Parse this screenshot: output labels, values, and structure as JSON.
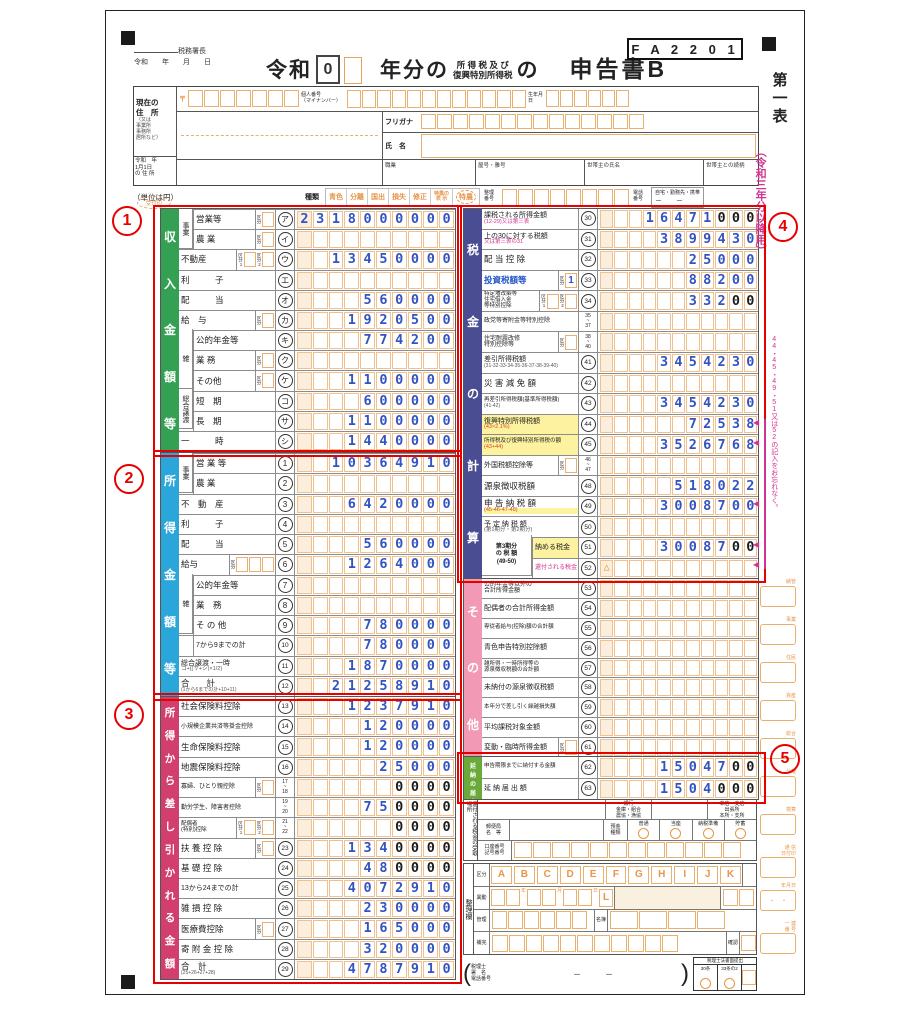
{
  "header": {
    "tax_office": "税務署長",
    "date_line": "令和　　年　　月　　日",
    "era_label": "令和",
    "era_value": "0",
    "title_year": "年分の",
    "title_tax_top": "所 得 税 及 び",
    "title_tax_bottom": "復興特別所得税",
    "title_no": "の",
    "title_form": "申告書B",
    "form_code": "F A 2 2 0 1",
    "current_address": [
      "現在の",
      "住　所"
    ],
    "address_alt": [
      "（又は",
      "事業所",
      "事務所",
      "居所など）"
    ],
    "postal_mark": "〒",
    "my_number_label": [
      "個人番号",
      "（マイナンバー）"
    ],
    "birth_label": "生年月日",
    "furigana_label": "フリガナ",
    "name_label": "氏　名",
    "jan1_label": [
      "令和　年",
      "1月1日",
      "の 住 所"
    ],
    "occupation_label": "職業",
    "trade_label": "屋号・雅号",
    "householder_label": "世帯主の氏名",
    "relation_label": "世帯主との続柄",
    "stamp_label": "受付印",
    "unit_note": "（単位は円）",
    "type_label": "種類",
    "types": [
      "青色",
      "分離",
      "国出",
      "損失",
      "修正",
      "特農の\n表 示",
      "特農"
    ],
    "serial_label": "整理\n番号",
    "phone_label": "電話\n番号",
    "phone_note": "自宅・勤務先・携帯",
    "phone_dashes": "－　　－"
  },
  "margin": {
    "sheet_name": "第一表",
    "edition": "（令和三年分以降用）",
    "reminder": "44・45・49・51又は52の記入をお忘れなく。",
    "boxes": [
      "納管",
      "事業",
      "住民",
      "資産",
      "総合",
      "分離",
      "検算",
      "通 信\n日付印",
      "年月日",
      "一 連\n番 号"
    ]
  },
  "annotations": [
    "1",
    "2",
    "3",
    "4",
    "5"
  ],
  "sections": {
    "income": {
      "bar": "収入金額等",
      "color": "#33a053",
      "slots": 10,
      "rows": [
        {
          "g": "事業",
          "gs": 2,
          "l": "営業等",
          "k": [
            {
              "t": "区分"
            }
          ],
          "c": "ア",
          "v": "2318000000"
        },
        {
          "g": "",
          "l": "農 業",
          "k": [
            {
              "t": "区分"
            }
          ],
          "c": "イ",
          "v": ""
        },
        {
          "l": "不動産",
          "k": [
            {
              "t": "区分1"
            },
            {
              "t": "区分2"
            }
          ],
          "c": "ウ",
          "v": "13450000"
        },
        {
          "l": "利　　　子",
          "c": "エ",
          "v": ""
        },
        {
          "l": "配　　　当",
          "c": "オ",
          "v": "560000"
        },
        {
          "l": "給　与",
          "k": [
            {
              "t": "区分"
            }
          ],
          "c": "カ",
          "v": "1920500"
        },
        {
          "g": "雑",
          "gs": 3,
          "l": "公的年金等",
          "c": "キ",
          "v": "774200"
        },
        {
          "g": "",
          "l": "業 務",
          "k": [
            {
              "t": "区分"
            }
          ],
          "c": "ク",
          "v": ""
        },
        {
          "g": "",
          "l": "その他",
          "k": [
            {
              "t": "区分"
            }
          ],
          "c": "ケ",
          "v": "1100000"
        },
        {
          "g": "総合譲渡",
          "gs": 2,
          "l": "短　期",
          "c": "コ",
          "v": "600000"
        },
        {
          "g": "",
          "l": "長　期",
          "c": "サ",
          "v": "1100000"
        },
        {
          "l": "一　　　時",
          "c": "シ",
          "v": "1440000"
        }
      ]
    },
    "shotoku": {
      "bar": "所得金額等",
      "color": "#2ba6da",
      "slots": 10,
      "rows": [
        {
          "g": "事業",
          "gs": 2,
          "l": "営 業 等",
          "c": "1",
          "v": "10364910"
        },
        {
          "g": "",
          "l": "農 業",
          "c": "2",
          "v": ""
        },
        {
          "l": "不　動　産",
          "c": "3",
          "v": "6420000"
        },
        {
          "l": "利　　　子",
          "c": "4",
          "v": ""
        },
        {
          "l": "配　　　当",
          "c": "5",
          "v": "560000"
        },
        {
          "l": "給与",
          "k": [
            {
              "t": "区分",
              "n": 3
            }
          ],
          "c": "6",
          "v": "1264000"
        },
        {
          "g": "雑",
          "gs": 3,
          "l": "公的年金等",
          "c": "7",
          "v": ""
        },
        {
          "g": "",
          "l": "業　務",
          "c": "8",
          "v": ""
        },
        {
          "g": "",
          "l": "そ の 他",
          "c": "9",
          "v": "780000"
        },
        {
          "g": "",
          "l": "7から9までの計",
          "lcls": "sm",
          "c": "10",
          "v": "780000"
        },
        {
          "l": "総合譲渡・一時",
          "lcls": "sm",
          "sub": "コ+{(サ+シ)×1/2}",
          "c": "11",
          "v": "1870000"
        },
        {
          "l": "合　　計",
          "sub": "(1から6までの計+10+11)",
          "scls": "xxs",
          "c": "12",
          "v": "21258910"
        }
      ]
    },
    "deductions": {
      "bar": "所得から差し引かれる金額",
      "color": "#d23f6e",
      "slots": 10,
      "rows": [
        {
          "l": "社会保険料控除",
          "c": "13",
          "v": "1237910"
        },
        {
          "l": "小規模企業共済等掛金控除",
          "lcls": "xs",
          "c": "14",
          "v": "120000"
        },
        {
          "l": "生命保険料控除",
          "c": "15",
          "v": "120000"
        },
        {
          "l": "地震保険料控除",
          "c": "16",
          "v": "25000"
        },
        {
          "l": "寡婦、ひとり親控除",
          "lcls": "xs",
          "k": [
            {
              "t": "区分"
            }
          ],
          "c": "17~18",
          "v": "0000",
          "b": 4
        },
        {
          "l": "勤労学生、障害者控除",
          "lcls": "xs",
          "c": "19~20",
          "v": "750000",
          "b": 4
        },
        {
          "l": "配偶者\n(特別)控除",
          "lcls": "xxs",
          "k": [
            {
              "t": "区分1"
            },
            {
              "t": "区分2"
            }
          ],
          "c": "21~22",
          "v": "0000",
          "b": 4
        },
        {
          "l": "扶 養 控 除",
          "k": [
            {
              "t": "区分"
            }
          ],
          "c": "23",
          "v": "1340000",
          "b": 4
        },
        {
          "l": "基 礎 控 除",
          "c": "24",
          "v": "480000",
          "b": 4
        },
        {
          "l": "13から24までの計",
          "lcls": "sm",
          "c": "25",
          "v": "4072910"
        },
        {
          "l": "雑 損 控 除",
          "c": "26",
          "v": "230000"
        },
        {
          "l": "医療費控除",
          "k": [
            {
              "t": "区分"
            }
          ],
          "c": "27",
          "v": "165000"
        },
        {
          "l": "寄 附 金 控 除",
          "c": "28",
          "v": "320000"
        },
        {
          "l": "合　計",
          "sub": "(25+26+27+28)",
          "scls": "xxs",
          "c": "29",
          "v": "4787910"
        }
      ]
    },
    "tax": {
      "bar": "税金の計算",
      "color": "#4b4d92",
      "slots": 11,
      "rows": [
        {
          "l": "課税される所得金額",
          "lcls": "sm",
          "sub": "(12-29)又は第三表",
          "scls": "mag",
          "c": "30",
          "v": "16471000",
          "b": 3
        },
        {
          "l": "上の30に対する税額",
          "lcls": "sm",
          "sub": "又は第三表の31",
          "scls": "mag",
          "c": "31",
          "v": "3899430"
        },
        {
          "l": "配 当 控 除",
          "c": "32",
          "v": "25000"
        },
        {
          "l": "投資税額等",
          "lcls": "blue",
          "k": [
            {
              "t": "区分",
              "v": "1"
            }
          ],
          "c": "33",
          "v": "88200"
        },
        {
          "l": "特定増改築等\n住宅借入金\n等特別控除",
          "lcls": "xxs",
          "k": [
            {
              "t": "区分1"
            },
            {
              "t": "区分2"
            }
          ],
          "c": "34",
          "v": "33200",
          "b": 2
        },
        {
          "l": "政党等寄附金等特別控除",
          "lcls": "xs",
          "c": "35~37",
          "v": ""
        },
        {
          "l": "住宅耐震改修\n特別控除等",
          "lcls": "xs",
          "k": [
            {
              "t": "区分"
            }
          ],
          "c": "38~40",
          "v": ""
        },
        {
          "l": "差引所得税額",
          "lcls": "sm",
          "sub": "(31-32-33-34-35-36-37-38-39-40)",
          "scls": "xxs",
          "c": "41",
          "v": "3454230"
        },
        {
          "l": "災 害 減 免 額",
          "c": "42",
          "v": ""
        },
        {
          "l": "再差引所得税額(基準所得税額)",
          "lcls": "xxs",
          "sub": "(41-42)",
          "scls": "xxs",
          "c": "43",
          "v": "3454230"
        },
        {
          "l": "復興特別所得税額",
          "lcls": "sm",
          "lbg": "#fdf2a0",
          "sub": "(43×2.1%)",
          "scls": "red",
          "c": "44",
          "v": "72538"
        },
        {
          "l": "所得税及び復興特別所得税の額",
          "lcls": "xxs",
          "lbg": "#fdf2a0",
          "sub": "(43+44)",
          "scls": "red",
          "c": "45",
          "v": "3526768"
        },
        {
          "l": "外国税額控除等",
          "lcls": "sm",
          "k": [
            {
              "t": "区分"
            }
          ],
          "c": "46~47",
          "v": ""
        },
        {
          "l": "源泉徴収税額",
          "c": "48",
          "v": "518022"
        },
        {
          "l": "申 告 納 税 額",
          "sub": "(45-46-47-48)",
          "scls": "red",
          "sbg": "#fdf2a0",
          "c": "49",
          "v": "3008700"
        },
        {
          "l": "予 定 納 税 額",
          "lcls": "sm",
          "sub": "(第1期分・第2期分)",
          "c": "50",
          "v": ""
        },
        {
          "g": "第3期分\nの 税 額\n(49-50)",
          "gs": 2,
          "gw": 50,
          "gcls": "wide",
          "l": "納める税金",
          "lcls": "sm",
          "lbg": "#fdf2a0",
          "c": "51",
          "v": "3008700",
          "b": 2
        },
        {
          "g": "",
          "gw": 50,
          "l": "還付される税金",
          "lcls": "xs mag",
          "c": "52",
          "v": "",
          "tri": true
        }
      ]
    },
    "other": {
      "bar": "その他",
      "color": "#f29ab5",
      "slots": 11,
      "rows": [
        {
          "l": "公的年金等以外の\n合計所得金額",
          "lcls": "xs",
          "c": "53",
          "v": ""
        },
        {
          "l": "配偶者の合計所得金額",
          "lcls": "sm",
          "c": "54",
          "v": ""
        },
        {
          "l": "専従者給与(控除)額の合計額",
          "lcls": "xxs",
          "c": "55",
          "v": ""
        },
        {
          "l": "青色申告特別控除額",
          "lcls": "sm",
          "c": "56",
          "v": ""
        },
        {
          "l": "雑所得・一時所得等の\n源泉徴収税額の合計額",
          "lcls": "xxs",
          "c": "57",
          "v": ""
        },
        {
          "l": "未納付の源泉徴収税額",
          "lcls": "sm",
          "c": "58",
          "v": ""
        },
        {
          "l": "本年分で差し引く繰越損失額",
          "lcls": "xxs",
          "c": "59",
          "v": ""
        },
        {
          "l": "平均課税対象金額",
          "lcls": "sm",
          "c": "60",
          "v": ""
        },
        {
          "l": "変動・臨時所得金額",
          "lcls": "sm",
          "k": [
            {
              "t": "区分"
            }
          ],
          "c": "61",
          "v": ""
        }
      ]
    },
    "ennou": {
      "bar": "延納の届出",
      "color": "#6aaa3a",
      "slots": 11,
      "rows": [
        {
          "l": "申告期限までに納付する金額",
          "lcls": "xxs",
          "c": "62",
          "v": "1504700",
          "b": 2
        },
        {
          "l": "延 納 届 出 額",
          "lcls": "sm",
          "c": "63",
          "v": "1504000",
          "b": 3
        }
      ]
    }
  },
  "bank": {
    "vertical": "還付される税金の受取場所",
    "bank_words": [
      "銀行",
      "金庫・組合",
      "農協・漁協"
    ],
    "branch_words": [
      "本店・支店",
      "出張所",
      "本所・支所"
    ],
    "post_label": [
      "郵便局",
      "名　等"
    ],
    "deposit_label": [
      "預金",
      "種類"
    ],
    "deposit_types": [
      "普通",
      "当座",
      "納税準備",
      "貯蓄"
    ],
    "account_label": [
      "口座番号",
      "記号番号"
    ]
  },
  "seiri": {
    "vertical": "整理欄",
    "kubun": "区分",
    "letters": [
      "A",
      "B",
      "C",
      "D",
      "E",
      "F",
      "G",
      "H",
      "I",
      "J",
      "K"
    ],
    "idou": "異動",
    "l_mark": "L",
    "date_units": [
      "年",
      "月",
      "日"
    ],
    "kanri": "管理",
    "meibo": "名簿",
    "hokan": "補完",
    "kakunin": "確認"
  },
  "accountant": {
    "label": [
      "税理士",
      "署　名",
      "電話番号"
    ],
    "dashes": "－　　　－",
    "law_title": "税理士法書面提出",
    "law_items": [
      "30条",
      "33条の2"
    ]
  }
}
